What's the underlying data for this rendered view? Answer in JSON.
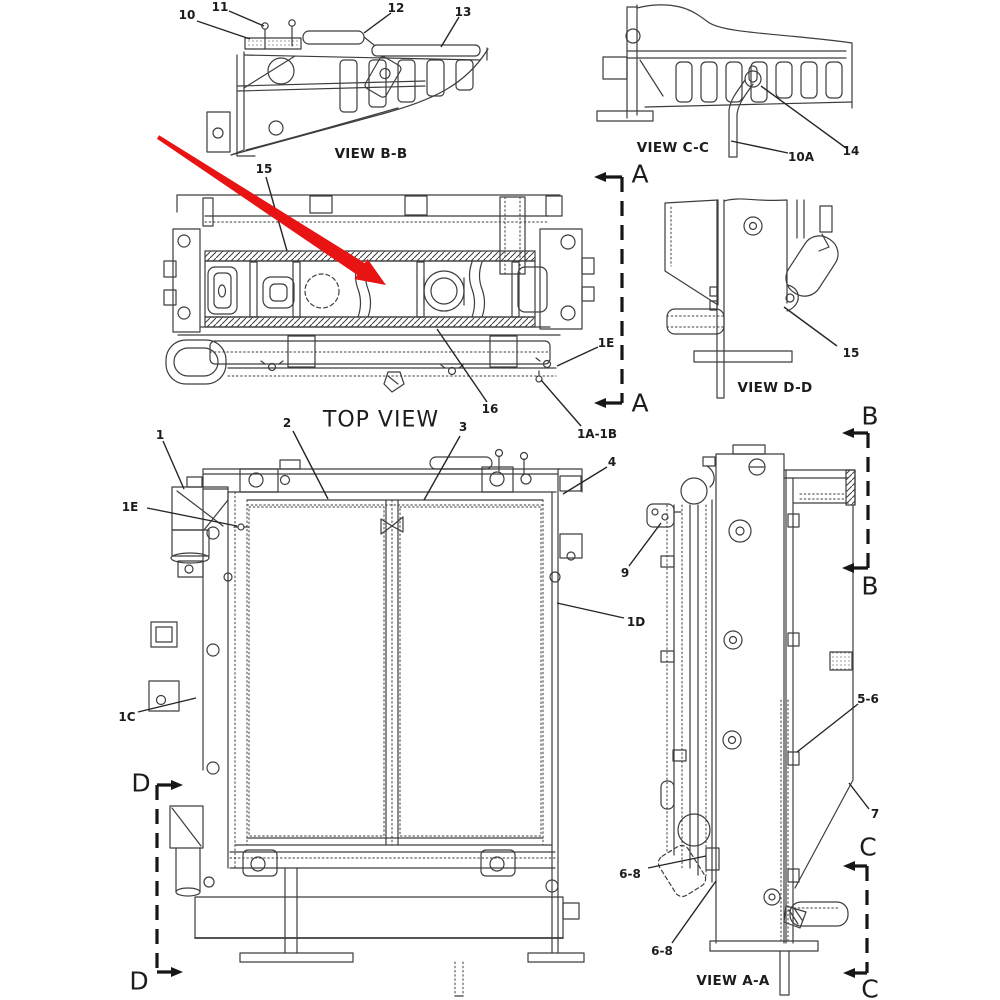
{
  "diagram": {
    "kind": "machine-parts-line-drawing",
    "background_color": "#ffffff",
    "line_color": "#3d3d3d",
    "text_color": "#1c1c1c",
    "highlight_arrow_color": "#e81414"
  },
  "views": {
    "view_bb": {
      "label": "VIEW B-B"
    },
    "view_cc": {
      "label": "VIEW C-C"
    },
    "top_view": {
      "label": "TOP VIEW"
    },
    "view_dd": {
      "label": "VIEW D-D"
    },
    "view_aa": {
      "label": "VIEW A-A"
    }
  },
  "callouts": {
    "c10": {
      "label": "10"
    },
    "c11": {
      "label": "11"
    },
    "c12": {
      "label": "12"
    },
    "c13": {
      "label": "13"
    },
    "c14": {
      "label": "14"
    },
    "c10a": {
      "label": "10A"
    },
    "c15_top": {
      "label": "15"
    },
    "c16": {
      "label": "16"
    },
    "c1e_top": {
      "label": "1E"
    },
    "c1a1b": {
      "label": "1A-1B"
    },
    "c15_dd": {
      "label": "15"
    },
    "c1": {
      "label": "1"
    },
    "c1e_front": {
      "label": "1E"
    },
    "c2": {
      "label": "2"
    },
    "c3": {
      "label": "3"
    },
    "c4": {
      "label": "4"
    },
    "c1c": {
      "label": "1C"
    },
    "c1d": {
      "label": "1D"
    },
    "c9": {
      "label": "9"
    },
    "c56": {
      "label": "5-6"
    },
    "c7": {
      "label": "7"
    },
    "c68_a": {
      "label": "6-8"
    },
    "c68_b": {
      "label": "6-8"
    }
  },
  "sections": {
    "a_top": {
      "label": "A"
    },
    "a_bottom": {
      "label": "A"
    },
    "b_top": {
      "label": "B"
    },
    "b_bottom": {
      "label": "B"
    },
    "c_top": {
      "label": "C"
    },
    "c_bottom": {
      "label": "C"
    },
    "d_top": {
      "label": "D"
    },
    "d_bottom": {
      "label": "D"
    }
  }
}
